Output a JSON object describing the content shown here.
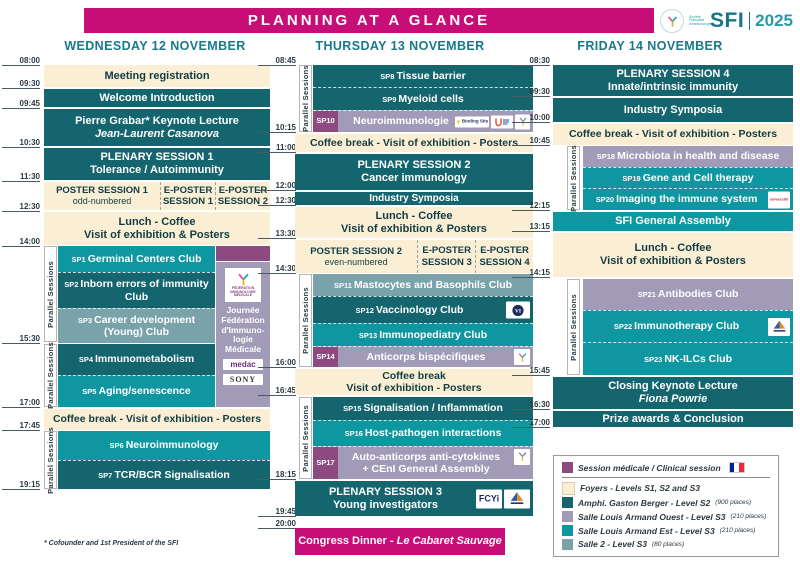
{
  "banner": {
    "title": "PLANNING AT A GLANCE"
  },
  "logo": {
    "name": "SFI",
    "year": "2025",
    "org": "Société Française d'Immunologie"
  },
  "labels": {
    "parallel": "Parallel Sessions"
  },
  "colors": {
    "magenta": "#c70d76",
    "dark_teal": "#15656f",
    "teal": "#0e97a0",
    "lavender": "#a29bb7",
    "clinical_purple": "#8c4a80",
    "salle2_gray": "#7aa2ab",
    "cream": "#faefd4",
    "header_teal": "#19798a"
  },
  "wed": {
    "header": "WEDNESDAY 12 NOVEMBER",
    "times": [
      "08:00",
      "09:30",
      "09:45",
      "10:30",
      "11:30",
      "12:30",
      "14:00",
      "15:30",
      "17:00",
      "17:45",
      "19:15"
    ],
    "registration": "Meeting registration",
    "welcome": "Welcome Introduction",
    "keynote": "Pierre Grabar* Keynote Lecture",
    "keynote_speaker": "Jean-Laurent Casanova",
    "plenary1": "PLENARY SESSION 1",
    "plenary1_topic": "Tolerance / Autoimmunity",
    "poster1": "POSTER SESSION 1",
    "poster1_note": "odd-numbered",
    "eposter1": "E-POSTER SESSION 1",
    "eposter2": "E-POSTER SESSION 2",
    "lunch": "Lunch - Coffee",
    "lunch2": "Visit of exhibition & Posters",
    "sp1": "SP1",
    "sp1_t": "Germinal Centers Club",
    "sp2": "SP2",
    "sp2_t": "Inborn errors of immunity Club",
    "sp3": "SP3",
    "sp3_t": "Career development (Young) Club",
    "sp4": "SP4",
    "sp4_t": "Immunometabolism",
    "sp5": "SP5",
    "sp5_t": "Aging/senescence",
    "fim_caption": "Journée Fédération d'Immuno­logie Médicale",
    "coffee": "Coffee break - Visit of exhibition - Posters",
    "sp6": "SP6",
    "sp6_t": "Neuroimmunology",
    "sp7": "SP7",
    "sp7_t": "TCR/BCR Signalisation"
  },
  "thu": {
    "header": "THURSDAY 13 NOVEMBER",
    "times": [
      "08:45",
      "10:15",
      "11:00",
      "12:00",
      "12:30",
      "13:30",
      "14:30",
      "16:00",
      "16:45",
      "18:15",
      "19:45",
      "20:00"
    ],
    "sp8": "SP8",
    "sp8_t": "Tissue barrier",
    "sp9": "SP9",
    "sp9_t": "Myeloid cells",
    "sp10": "SP10",
    "sp10_t": "Neuroimmunologie",
    "coffee1": "Coffee break - Visit of exhibition - Posters",
    "plenary2": "PLENARY SESSION 2",
    "plenary2_topic": "Cancer immunology",
    "industry": "Industry Symposia",
    "lunch": "Lunch - Coffee",
    "lunch2": "Visit of exhibition & Posters",
    "poster2": "POSTER SESSION 2",
    "poster2_note": "even-numbered",
    "eposter3": "E-POSTER SESSION 3",
    "eposter4": "E-POSTER SESSION 4",
    "sp11": "SP11",
    "sp11_t": "Mastocytes and Basophils Club",
    "sp12": "SP12",
    "sp12_t": "Vaccinology Club",
    "sp13": "SP13",
    "sp13_t": "Immunopediatry Club",
    "sp14": "SP14",
    "sp14_t": "Anticorps bispécifiques",
    "coffee2": "Coffee break",
    "coffee2b": "Visit of exhibition - Posters",
    "sp15": "SP15",
    "sp15_t": "Signalisation / Inflammation",
    "sp16": "SP16",
    "sp16_t": "Host-pathogen interactions",
    "sp17": "SP17",
    "sp17_t": "Auto-anticorps anti-cytokines",
    "sp17_b": "+ CEnI General Assembly",
    "plenary3": "PLENARY SESSION 3",
    "plenary3_topic": "Young investigators",
    "dinner": "Congress Dinner",
    "dinner_sep": " - ",
    "dinner_venue": "Le Cabaret Sauvage"
  },
  "fri": {
    "header": "FRIDAY 14 NOVEMBER",
    "times": [
      "08:30",
      "09:30",
      "10:00",
      "10:45",
      "12:15",
      "13:15",
      "14:15",
      "15:45",
      "16:30",
      "17:00"
    ],
    "plenary4": "PLENARY SESSION 4",
    "plenary4_topic": "Innate/intrinsic immunity",
    "industry": "Industry Symposia",
    "coffee1": "Coffee break - Visit of exhibition - Posters",
    "sp18": "SP18",
    "sp18_t": "Microbiota in health and disease",
    "sp19": "SP19",
    "sp19_t": "Gene and Cell therapy",
    "sp20": "SP20",
    "sp20_t": "Imaging the immune system",
    "ga": "SFI General Assembly",
    "lunch": "Lunch - Coffee",
    "lunch2": "Visit of exhibition & Posters",
    "sp21": "SP21",
    "sp21_t": "Antibodies Club",
    "sp22": "SP22",
    "sp22_t": "Immunotherapy Club",
    "sp23": "SP23",
    "sp23_t": "NK-ILCs Club",
    "closing": "Closing Keynote Lecture",
    "closing_speaker": "Fiona Powrie",
    "prize": "Prize awards & Conclusion"
  },
  "legend": {
    "clinical": "Session médicale / Clinical session",
    "foyers": "Foyers - Levels S1, S2 and S3",
    "amphi": "Amphi. Gaston Berger - Level S2",
    "amphi_places": "(900 places)",
    "ouest": "Salle Louis Armand Ouest - Level S3",
    "ouest_places": "(210 places)",
    "est": "Salle Louis Armand Est - Level S3",
    "est_places": "(210 places)",
    "salle2": "Salle 2 - Level S3",
    "salle2_places": "(80 places)"
  },
  "logos": {
    "fim_box": "FÉDÉRATION IMMUNOLOGIE MÉDICALE",
    "medac": "medac",
    "sony": "SONY",
    "binding": "Binding Site",
    "fcyi": "FCYi",
    "universite": "université"
  },
  "footnote": "* Cofounder and 1st President of the SFI"
}
